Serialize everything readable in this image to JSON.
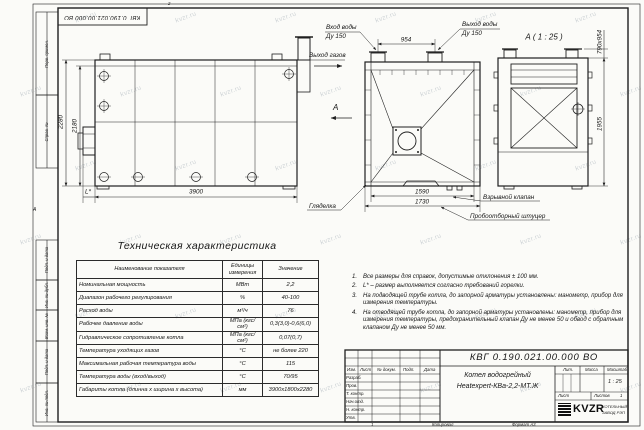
{
  "meta": {
    "watermark_text": "kvzr.ru"
  },
  "frame": {
    "top_stamp": "КВГ 0.190.021.00.000 ВО",
    "zone_top": "2",
    "zone_bottom": "1",
    "zone_left": "А",
    "left_strip": [
      {
        "label": "Перв. примен."
      },
      {
        "label": "Справ. №"
      },
      {
        "label": "Подп. и дата"
      },
      {
        "label": "Инв. № дубл."
      },
      {
        "label": "Взам. инв. №"
      },
      {
        "label": "Подп. и дата"
      },
      {
        "label": "Инв. № подл."
      }
    ]
  },
  "drawing": {
    "side_view": {
      "dim_height_outer": "2280",
      "dim_height_inner": "2180",
      "dim_length": "3900",
      "dim_burner": "L*",
      "gas_outlet_label": "Выход газов",
      "view_arrow_label": "А"
    },
    "front_view": {
      "inlet_label_1": "Вход воды",
      "inlet_label_2": "Ду 150",
      "outlet_label_1": "Выход воды",
      "outlet_label_2": "Ду 150",
      "dim_nozzles": "954",
      "dim_width_inner": "1590",
      "dim_width_outer": "1730",
      "sight_glass_label": "Гляделка",
      "explosion_valve_label": "Взрывной клапан",
      "sampling_label": "Пробоотборный штуцер"
    },
    "detail_view": {
      "title": "А ( 1 : 25 )",
      "dim_opening": "790х954",
      "dim_height": "1955"
    }
  },
  "spec_table": {
    "title": "Техническая характеристика",
    "col_name": "Наименование показателя",
    "col_unit_1": "Единицы",
    "col_unit_2": "измерения",
    "col_value": "Значение",
    "rows": [
      {
        "name": "Номинальная мощность",
        "unit": "МВт",
        "value": "2,2"
      },
      {
        "name": "Диапазон рабочего регулирования",
        "unit": "%",
        "value": "40-100"
      },
      {
        "name": "Расход воды",
        "unit": "м³/ч",
        "value": "76"
      },
      {
        "name": "Рабочее давление воды",
        "unit": "МПа (кгс/см²)",
        "value": "0,3(3,0)-0,6(6,0)"
      },
      {
        "name": "Гидравлическое сопротивление котла",
        "unit": "МПа (кгс/см²)",
        "value": "0,07(0,7)"
      },
      {
        "name": "Температура уходящих газов",
        "unit": "°С",
        "value": "не более 220"
      },
      {
        "name": "Максимальная рабочая температура воды",
        "unit": "°С",
        "value": "115"
      },
      {
        "name": "Температура воды (вход/выход)",
        "unit": "°С",
        "value": "70/95"
      },
      {
        "name": "Габариты котла (длинна х ширина х высота)",
        "unit": "мм",
        "value": "3900х1800х2280"
      }
    ]
  },
  "notes": [
    {
      "num": "1.",
      "text": "Все размеры для справок, допустимые отклонения ± 100 мм."
    },
    {
      "num": "2.",
      "text": "L* – размер выполняется согласно требований горелки."
    },
    {
      "num": "3.",
      "text": "На подводящей трубе котла, до запорной арматуры установлены: манометр, прибор для измерения температуры."
    },
    {
      "num": "4.",
      "text": "На отводящей трубе котла, до запорной арматуры установлены: манометр, прибор для измерения температуры, предохранительный клапан Ду не менее 50 и обвод с обратным клапаном Ду не менее 50 мм."
    }
  ],
  "title_block": {
    "doc_number": "КВГ 0.190.021.00.000 ВО",
    "product_line1": "Котел водогрейный",
    "product_line2": "Heatexpert-КВа-2,2-МТ.Ж",
    "col_izm": "Изм.",
    "col_list": "Лист",
    "col_doc": "№ докум.",
    "col_podp": "Подп.",
    "col_data": "Дата",
    "row_labels": [
      "Разраб.",
      "Пров.",
      "Т. контр.",
      "Нач.отд.",
      "Н. контр.",
      "Утв."
    ],
    "lit_label": "Лит.",
    "mass_label": "Масса",
    "scale_label": "Масштаб",
    "scale_value": "1 : 25",
    "sheet_label": "Лист",
    "sheets_label": "Листов",
    "sheets_value": "1",
    "logo_text": "KVZR",
    "logo_sub1": "КОТЕЛЬНЫЙ",
    "logo_sub2": "ЗАВОД РЭП",
    "copied_label": "Копировал",
    "format_label": "Формат А3"
  }
}
